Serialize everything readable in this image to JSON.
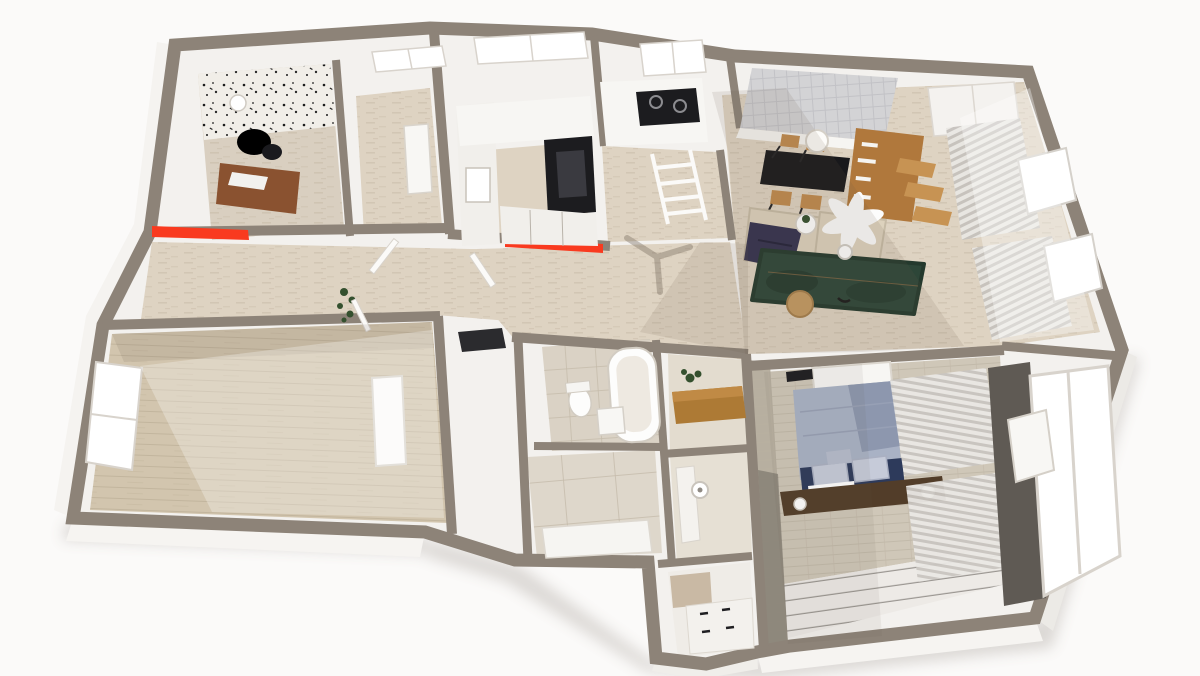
{
  "scene": {
    "description": "3D axonometric dollhouse render of an apartment floor plan, viewed from above; no visible text in image",
    "view": "top-down perspective, plan rotated slightly clockwise",
    "background": "#fbfaf9",
    "red_markers_count": 2
  },
  "colors": {
    "bg": "#fbfaf9",
    "wall_top": "#8d8378",
    "wall_top_shadow": "#7c736a",
    "wall_face": "#f3f1ee",
    "wall_face_bright": "#fafaf8",
    "wall_face_shadow": "#d9d4cd",
    "accent_red": "#f93a1f",
    "floor_travertine": "#ded3c2",
    "floor_wood": "#d2c5ae",
    "floor_tile": "#dad2c5",
    "floor_tile_big": "#ded7cb",
    "floor_plank_white": "#edeae6",
    "brick_floor": "#cfc7b8",
    "brick_wall": "#b7afa0",
    "brick_wall_dark": "#6e675f",
    "office_floor": "#d9cfc0",
    "wallpaper": "#f1eee8",
    "cabinet_white": "#f1efeb",
    "counter_white": "#f7f6f3",
    "appliance_black": "#1c1c1f",
    "dining_table_black": "#18181b",
    "wood_chair": "#c08a4e",
    "bookshelf_wood": "#b0783c",
    "step_wood": "#c79353",
    "console_wood": "#ad7a35",
    "shelf_dark_wood": "#523d29",
    "desk_wood": "#8a5230",
    "sofa_cream": "#ddd2bd",
    "sofa_cream_dark": "#cbbfa8",
    "blanket_navy": "#34324f",
    "rug_green": "#2d4638",
    "rug_green_dark": "#1f3428",
    "side_table_tan": "#c39a62",
    "bed_duvet": "#a9b2c5",
    "bed_duvet_dark": "#8d97ae",
    "bed_base_navy": "#2d3a5b",
    "pillow_gray": "#c6cbd9",
    "curtain_light": "#e9e7e3",
    "curtain_dark": "#c4c0bb",
    "panel_gray": "#d3d3d5",
    "glass_white": "#ffffff",
    "plant_green": "#34502e",
    "fan_white": "#fcfcfc",
    "toilet_white": "#fdfdfc",
    "tan_cabinet": "#c9b9a4",
    "shadow_warm": "#6b5b4a"
  },
  "rooms": [
    {
      "id": "home-office",
      "floor": "beige",
      "features": [
        "patterned-accent-wall",
        "desk",
        "office-chair",
        "pendant-lamp",
        "window"
      ]
    },
    {
      "id": "bedroom-2",
      "floor": "travertine",
      "features": [
        "window",
        "wall-bench"
      ]
    },
    {
      "id": "kitchen",
      "floor": "travertine",
      "features": [
        "white-cabinets",
        "oven-tower",
        "sink",
        "gas-cooktop",
        "windows",
        "red-wall-marker"
      ]
    },
    {
      "id": "pantry-hall",
      "floor": "travertine",
      "features": [
        "ladder-shelf"
      ]
    },
    {
      "id": "living-dining",
      "floor": "travertine",
      "features": [
        "dining-table",
        "dining-chairs-x4",
        "pendant-lamp",
        "wall-panel-screen",
        "bookshelf-with-steps",
        "wardrobe",
        "sofa-x2",
        "navy-throw",
        "coffee-table",
        "ceiling-fan",
        "fan-shadow",
        "area-rug",
        "side-table",
        "curtains",
        "open-windows"
      ]
    },
    {
      "id": "hallway",
      "floor": "travertine",
      "features": [
        "plant",
        "open-doors",
        "red-wall-marker"
      ]
    },
    {
      "id": "bathroom",
      "floor": "tile",
      "features": [
        "bathtub",
        "toilet",
        "cabinet"
      ]
    },
    {
      "id": "dressing-room",
      "floor": "big-tile",
      "features": [
        "counter"
      ]
    },
    {
      "id": "wc",
      "floor": "tile",
      "features": [
        "toilet-paper-holder",
        "counter"
      ]
    },
    {
      "id": "laundry-closet",
      "floor": "white",
      "features": [
        "tan-cabinet",
        "drawer-unit"
      ]
    },
    {
      "id": "master-bedroom",
      "floor": "brick-and-white-plank",
      "features": [
        "double-bed",
        "duvet",
        "pillows",
        "headboard-shelf",
        "sconce-lamp-x2",
        "tv-panel",
        "curtains",
        "windows",
        "brick-accent-wall"
      ]
    },
    {
      "id": "bedroom-3",
      "floor": "wood",
      "features": [
        "window",
        "radiator"
      ]
    },
    {
      "id": "balcony",
      "features": [
        "open-casement-windows"
      ]
    }
  ]
}
